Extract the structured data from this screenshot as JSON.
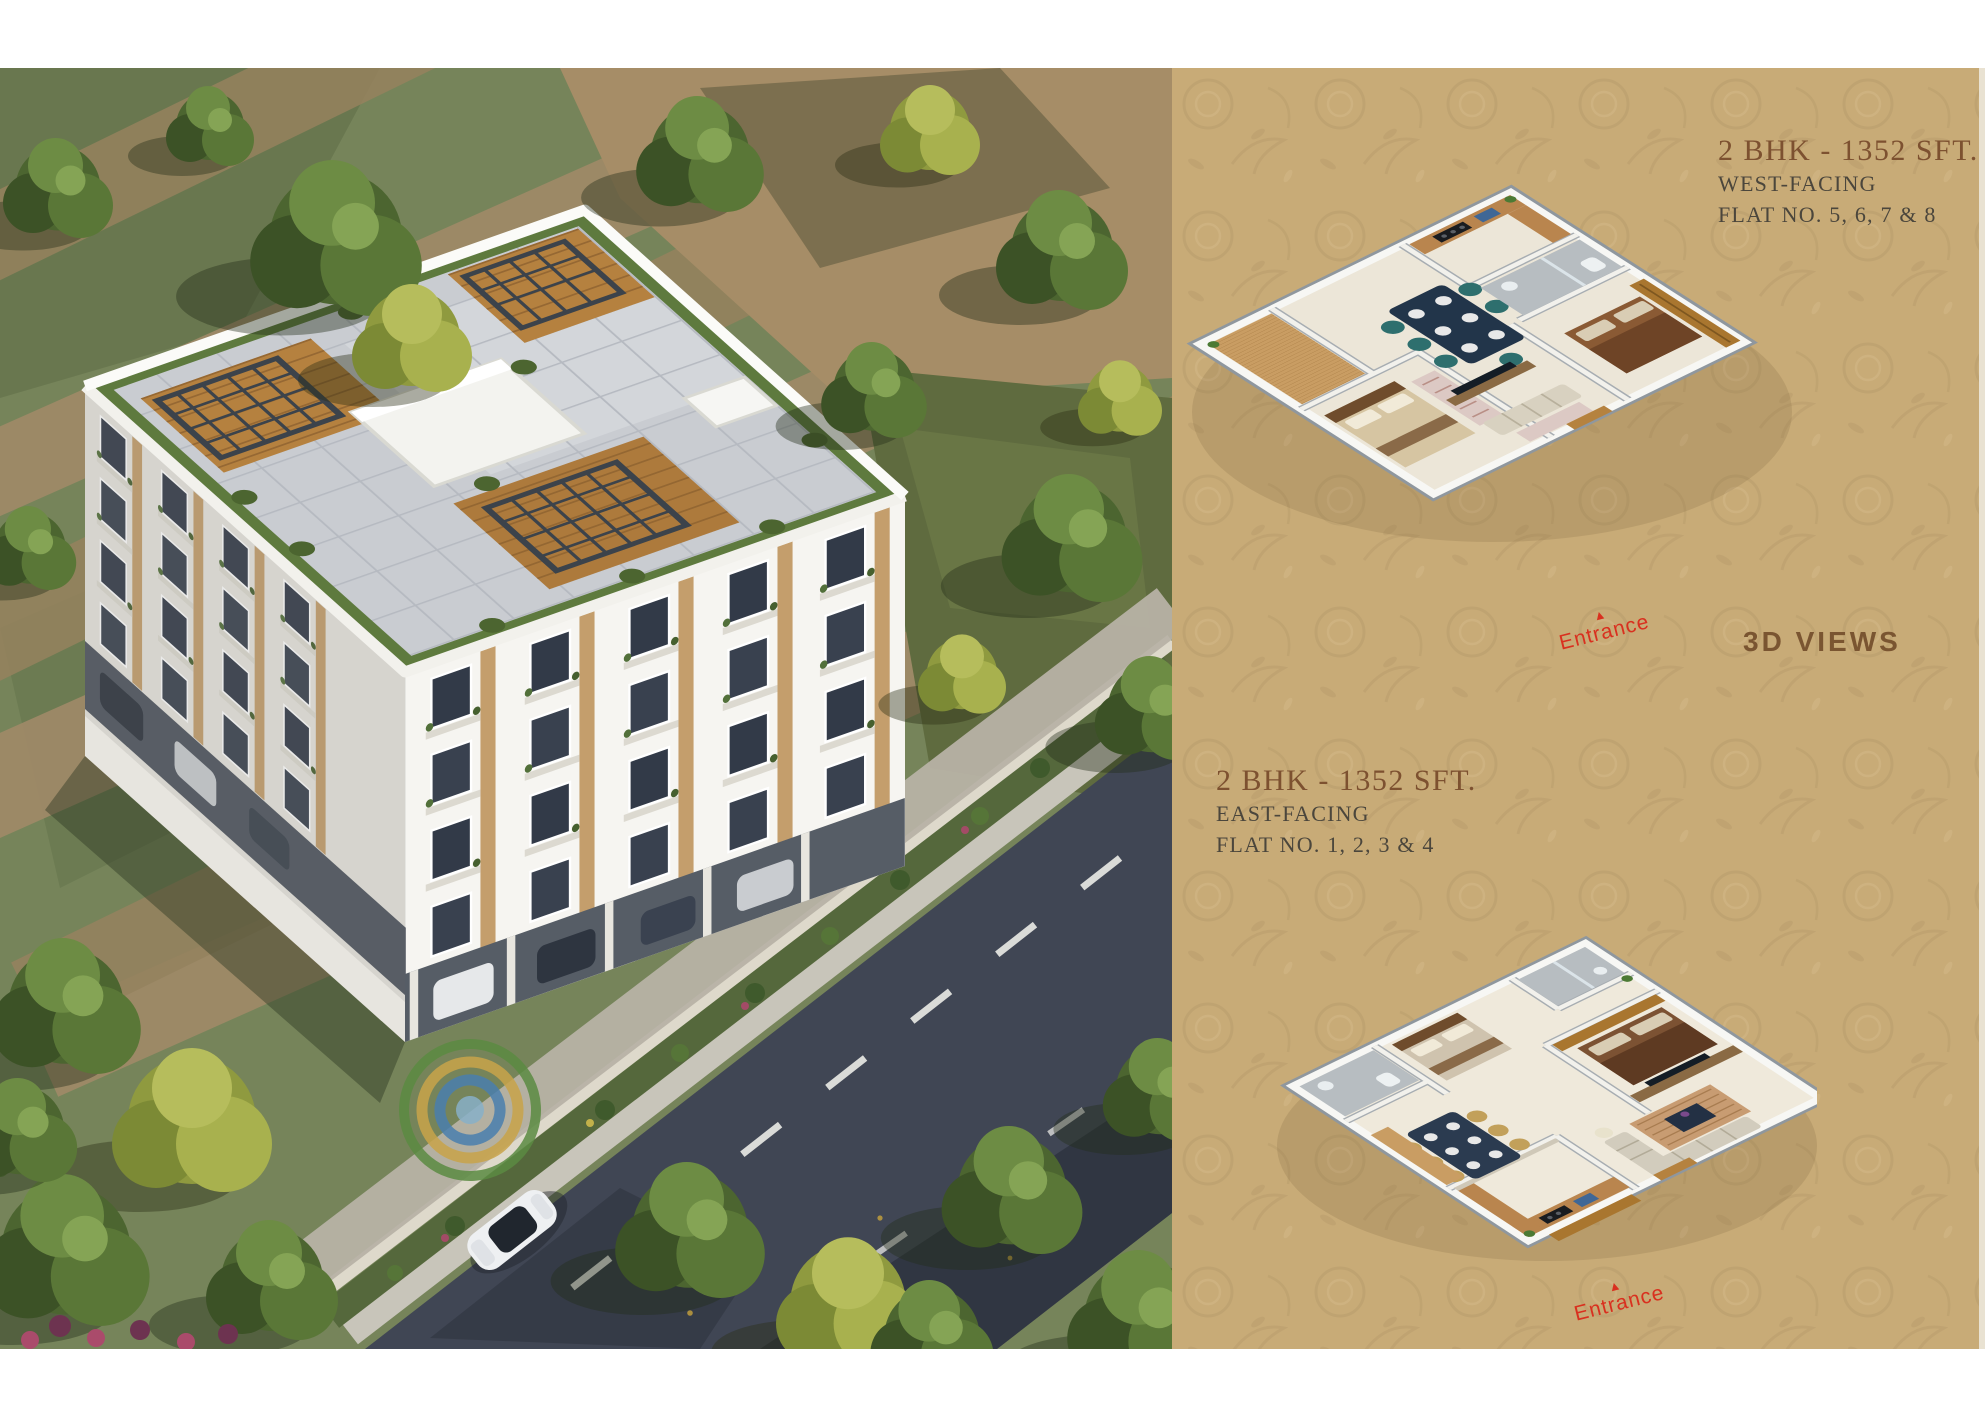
{
  "page": {
    "panel_bg": "#c8ab77",
    "accent_brown": "#7d5130",
    "text_dark": "#4b463c",
    "entrance_red": "#d9301f"
  },
  "right_panel": {
    "west_unit": {
      "title": "2 BHK - 1352 SFT.",
      "facing": "WEST-FACING",
      "flats": "FLAT NO. 5, 6, 7 & 8",
      "entrance_label": "Entrance"
    },
    "views_label": "3D VIEWS",
    "east_unit": {
      "title": "2 BHK - 1352 SFT.",
      "facing": "EAST-FACING",
      "flats": "FLAT NO. 1, 2, 3 & 4",
      "entrance_label": "Entrance"
    }
  }
}
